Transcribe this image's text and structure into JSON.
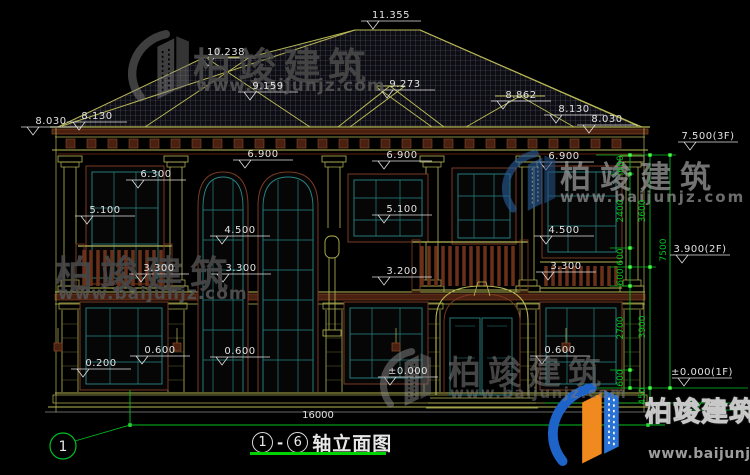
{
  "drawing": {
    "title": {
      "axis_from": "1",
      "axis_to": "6",
      "name": "轴立面图"
    },
    "axis_bubble": "1",
    "overall_width_dim": "16000",
    "elevation_labels": [
      {
        "t": "11.355",
        "x": 391,
        "y": 10
      },
      {
        "t": "10.238",
        "x": 226,
        "y": 47
      },
      {
        "t": "9.159",
        "x": 268,
        "y": 81
      },
      {
        "t": "9.273",
        "x": 405,
        "y": 79
      },
      {
        "t": "8.862",
        "x": 521,
        "y": 90
      },
      {
        "t": "8.030",
        "x": 51,
        "y": 116
      },
      {
        "t": "8.130",
        "x": 97,
        "y": 111
      },
      {
        "t": "8.130",
        "x": 574,
        "y": 104
      },
      {
        "t": "8.030",
        "x": 607,
        "y": 114
      },
      {
        "t": "6.900",
        "x": 263,
        "y": 149
      },
      {
        "t": "6.900",
        "x": 402,
        "y": 150
      },
      {
        "t": "6.900",
        "x": 564,
        "y": 151
      },
      {
        "t": "6.300",
        "x": 156,
        "y": 169
      },
      {
        "t": "5.100",
        "x": 105,
        "y": 205
      },
      {
        "t": "5.100",
        "x": 402,
        "y": 204
      },
      {
        "t": "4.500",
        "x": 240,
        "y": 225
      },
      {
        "t": "4.500",
        "x": 564,
        "y": 225
      },
      {
        "t": "3.300",
        "x": 159,
        "y": 263
      },
      {
        "t": "3.300",
        "x": 241,
        "y": 263
      },
      {
        "t": "3.300",
        "x": 566,
        "y": 261
      },
      {
        "t": "3.200",
        "x": 402,
        "y": 266
      },
      {
        "t": "0.600",
        "x": 160,
        "y": 345
      },
      {
        "t": "0.200",
        "x": 101,
        "y": 358
      },
      {
        "t": "0.600",
        "x": 240,
        "y": 346
      },
      {
        "t": "0.600",
        "x": 560,
        "y": 345
      },
      {
        "t": "±0.000",
        "x": 408,
        "y": 366
      },
      {
        "t": "7.500(3F)",
        "x": 708,
        "y": 131
      },
      {
        "t": "3.900(2F)",
        "x": 700,
        "y": 244
      },
      {
        "t": "±0.000(1F)",
        "x": 702,
        "y": 367
      }
    ],
    "vertical_dims": [
      {
        "t": "600",
        "x": 621,
        "y": 164
      },
      {
        "t": "2400",
        "x": 621,
        "y": 211
      },
      {
        "t": "600",
        "x": 621,
        "y": 257
      },
      {
        "t": "600",
        "x": 621,
        "y": 277
      },
      {
        "t": "2700",
        "x": 621,
        "y": 328
      },
      {
        "t": "600",
        "x": 621,
        "y": 378
      },
      {
        "t": "3600",
        "x": 643,
        "y": 211
      },
      {
        "t": "3900",
        "x": 643,
        "y": 327
      },
      {
        "t": "450",
        "x": 643,
        "y": 396
      },
      {
        "t": "7500",
        "x": 664,
        "y": 250
      }
    ]
  },
  "watermark": {
    "brand": "柏竣建筑",
    "url": "www.baijunjz.com",
    "registered": "®"
  },
  "colors": {
    "oy": "#b8b855",
    "tw": "#e2e2e2",
    "dg": "#00c020",
    "tg": "#00d400",
    "tl": "#2a8585",
    "br": "#7a3a22",
    "bl": "#1e63c8",
    "or": "#f08a1e"
  }
}
